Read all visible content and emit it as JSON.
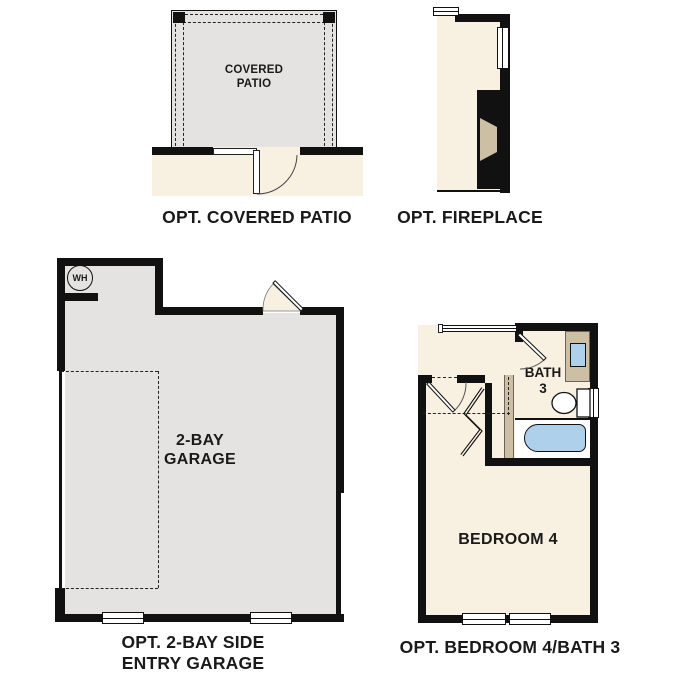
{
  "patio": {
    "room_line1": "COVERED",
    "room_line2": "PATIO",
    "caption": "OPT. COVERED PATIO"
  },
  "fireplace": {
    "caption": "OPT. FIREPLACE"
  },
  "garage": {
    "wh_label": "WH",
    "room_line1": "2-BAY",
    "room_line2": "GARAGE",
    "caption_line1": "OPT. 2-BAY SIDE",
    "caption_line2": "ENTRY GARAGE"
  },
  "bedroom_bath": {
    "bath_line1": "BATH",
    "bath_line2": "3",
    "bedroom_label": "BEDROOM 4",
    "caption": "OPT. BEDROOM 4/BATH 3"
  },
  "colors": {
    "wall": "#111111",
    "patio_floor": "#e4e3e1",
    "interior_floor": "#f8f0e1",
    "cabinet_tan": "#cdbfa3",
    "fixture_blue": "#afd0ea",
    "text": "#1a1a1a"
  }
}
